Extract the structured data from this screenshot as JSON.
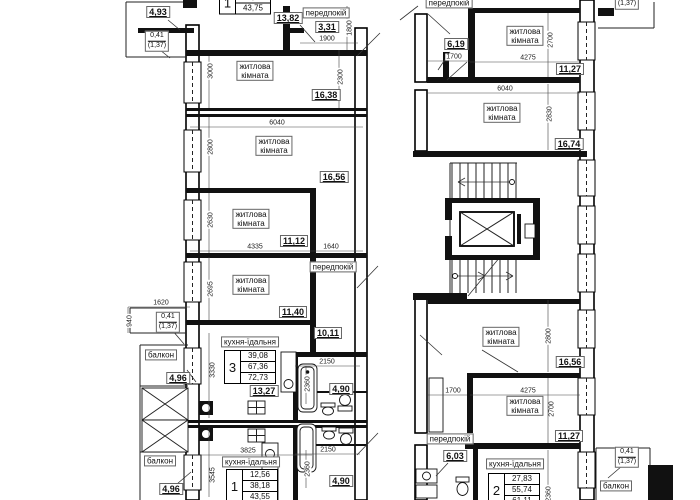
{
  "floor_plan": {
    "type": "apartment-building-floor-plan",
    "language": "ukrainian",
    "room_labels": [
      {
        "id": "living-room-l1",
        "lines": [
          "житлова",
          "кімната"
        ],
        "x": 255,
        "y": 71
      },
      {
        "id": "living-room-l2",
        "lines": [
          "житлова",
          "кімната"
        ],
        "x": 274,
        "y": 146
      },
      {
        "id": "living-room-l3",
        "lines": [
          "житлова",
          "кімната"
        ],
        "x": 251,
        "y": 219
      },
      {
        "id": "living-room-l4",
        "lines": [
          "житлова",
          "кімната"
        ],
        "x": 251,
        "y": 285
      },
      {
        "id": "living-room-r1",
        "lines": [
          "житлова",
          "кімната"
        ],
        "x": 525,
        "y": 36
      },
      {
        "id": "living-room-r2",
        "lines": [
          "житлова",
          "кімната"
        ],
        "x": 502,
        "y": 113
      },
      {
        "id": "living-room-r3",
        "lines": [
          "житлова",
          "кімната"
        ],
        "x": 501,
        "y": 337
      },
      {
        "id": "living-room-r4",
        "lines": [
          "житлова",
          "кімната"
        ],
        "x": 525,
        "y": 406
      },
      {
        "id": "hall-top-left",
        "lines": [
          "передпокій"
        ],
        "x": 326,
        "y": 13
      },
      {
        "id": "hall-left",
        "lines": [
          "передпокій"
        ],
        "x": 333,
        "y": 267
      },
      {
        "id": "hall-top-right",
        "lines": [
          "передпокій"
        ],
        "x": 449,
        "y": 3
      },
      {
        "id": "hall-bottom-right",
        "lines": [
          "передпокій"
        ],
        "x": 450,
        "y": 439
      },
      {
        "id": "kitchen-apt3",
        "lines": [
          "кухня-їдальня"
        ],
        "x": 250,
        "y": 342
      },
      {
        "id": "kitchen-apt1",
        "lines": [
          "кухня-їдальня"
        ],
        "x": 251,
        "y": 462
      },
      {
        "id": "kitchen-apt2",
        "lines": [
          "кухня-їдальня"
        ],
        "x": 515,
        "y": 464
      },
      {
        "id": "balcony-left-1",
        "lines": [
          "балкон"
        ],
        "x": 161,
        "y": 355
      },
      {
        "id": "balcony-left-2",
        "lines": [
          "балкон"
        ],
        "x": 160,
        "y": 461
      },
      {
        "id": "balcony-right",
        "lines": [
          "балкон"
        ],
        "x": 616,
        "y": 486
      }
    ],
    "area_labels": [
      {
        "id": "a-493",
        "text": "4,93",
        "x": 158,
        "y": 12
      },
      {
        "id": "a-1382",
        "text": "13,82",
        "x": 288,
        "y": 18
      },
      {
        "id": "a-331",
        "text": "3,31",
        "x": 327,
        "y": 27
      },
      {
        "id": "a-1638",
        "text": "16,38",
        "x": 326,
        "y": 95
      },
      {
        "id": "a-1656-l",
        "text": "16,56",
        "x": 334,
        "y": 177
      },
      {
        "id": "a-1112",
        "text": "11,12",
        "x": 294,
        "y": 241
      },
      {
        "id": "a-1140",
        "text": "11,40",
        "x": 293,
        "y": 312
      },
      {
        "id": "a-1011",
        "text": "10,11",
        "x": 328,
        "y": 333
      },
      {
        "id": "a-496-1",
        "text": "4,96",
        "x": 178,
        "y": 378
      },
      {
        "id": "a-496-2",
        "text": "4,96",
        "x": 171,
        "y": 489
      },
      {
        "id": "a-1327",
        "text": "13,27",
        "x": 264,
        "y": 391
      },
      {
        "id": "a-490-1",
        "text": "4,90",
        "x": 341,
        "y": 389
      },
      {
        "id": "a-490-2",
        "text": "4,90",
        "x": 341,
        "y": 481
      },
      {
        "id": "a-619",
        "text": "6,19",
        "x": 456,
        "y": 44
      },
      {
        "id": "a-1127-r1",
        "text": "11,27",
        "x": 570,
        "y": 69
      },
      {
        "id": "a-1674",
        "text": "16,74",
        "x": 569,
        "y": 144
      },
      {
        "id": "a-1656-r",
        "text": "16,56",
        "x": 570,
        "y": 362
      },
      {
        "id": "a-1127-r2",
        "text": "11,27",
        "x": 569,
        "y": 436
      },
      {
        "id": "a-603",
        "text": "6,03",
        "x": 455,
        "y": 456
      }
    ],
    "dimensions": [
      {
        "text": "1900",
        "x": 327,
        "y": 39,
        "v": false
      },
      {
        "text": "1800",
        "x": 350,
        "y": 28,
        "v": true
      },
      {
        "text": "3000",
        "x": 211,
        "y": 71,
        "v": true
      },
      {
        "text": "2300",
        "x": 341,
        "y": 77,
        "v": true
      },
      {
        "text": "6040",
        "x": 277,
        "y": 123,
        "v": false
      },
      {
        "text": "2800",
        "x": 211,
        "y": 147,
        "v": true
      },
      {
        "text": "2630",
        "x": 211,
        "y": 220,
        "v": true
      },
      {
        "text": "4335",
        "x": 255,
        "y": 247,
        "v": false
      },
      {
        "text": "1640",
        "x": 331,
        "y": 247,
        "v": false
      },
      {
        "text": "2695",
        "x": 211,
        "y": 289,
        "v": true
      },
      {
        "text": "1620",
        "x": 161,
        "y": 303,
        "v": false
      },
      {
        "text": "940",
        "x": 130,
        "y": 321,
        "v": true
      },
      {
        "text": "3330",
        "x": 213,
        "y": 370,
        "v": true
      },
      {
        "text": "2150",
        "x": 327,
        "y": 362,
        "v": false
      },
      {
        "text": "2360",
        "x": 308,
        "y": 384,
        "v": true
      },
      {
        "text": "3825",
        "x": 248,
        "y": 451,
        "v": false
      },
      {
        "text": "3545",
        "x": 213,
        "y": 475,
        "v": true
      },
      {
        "text": "2150",
        "x": 328,
        "y": 450,
        "v": false
      },
      {
        "text": "2360",
        "x": 308,
        "y": 469,
        "v": true
      },
      {
        "text": "1700",
        "x": 454,
        "y": 57,
        "v": false
      },
      {
        "text": "2700",
        "x": 551,
        "y": 40,
        "v": true
      },
      {
        "text": "4275",
        "x": 528,
        "y": 58,
        "v": false
      },
      {
        "text": "6040",
        "x": 505,
        "y": 89,
        "v": false
      },
      {
        "text": "2830",
        "x": 550,
        "y": 114,
        "v": true
      },
      {
        "text": "2800",
        "x": 549,
        "y": 336,
        "v": true
      },
      {
        "text": "1700",
        "x": 453,
        "y": 391,
        "v": false
      },
      {
        "text": "4275",
        "x": 528,
        "y": 391,
        "v": false
      },
      {
        "text": "2700",
        "x": 552,
        "y": 409,
        "v": true
      },
      {
        "text": "2360",
        "x": 549,
        "y": 494,
        "v": true
      }
    ],
    "balcony_coefficients": [
      {
        "id": "coef-top-left",
        "top": "0,41",
        "bottom": "(1,37)",
        "x": 157,
        "y": 41
      },
      {
        "id": "coef-mid-left",
        "top": "0,41",
        "bottom": "(1,37)",
        "x": 168,
        "y": 322
      },
      {
        "id": "coef-top-right",
        "top": "0,41",
        "bottom": "(1,37)",
        "x": 627,
        "y": -1
      },
      {
        "id": "coef-bottom-right",
        "top": "0,41",
        "bottom": "(1,37)",
        "x": 627,
        "y": 457
      }
    ],
    "apartment_tables": [
      {
        "id": "apt-top-1",
        "num": "1",
        "rows": [
          "38,41",
          "43,75"
        ],
        "x": 245,
        "y": 3
      },
      {
        "id": "apt-3",
        "num": "3",
        "rows": [
          "39,08",
          "67,36",
          "72,73"
        ],
        "x": 250,
        "y": 367
      },
      {
        "id": "apt-bottom-1",
        "num": "1",
        "rows": [
          "12,56",
          "38,18",
          "43,55"
        ],
        "x": 252,
        "y": 486
      },
      {
        "id": "apt-2",
        "num": "2",
        "rows": [
          "27,83",
          "55,74",
          "61,11"
        ],
        "x": 514,
        "y": 490
      }
    ]
  }
}
